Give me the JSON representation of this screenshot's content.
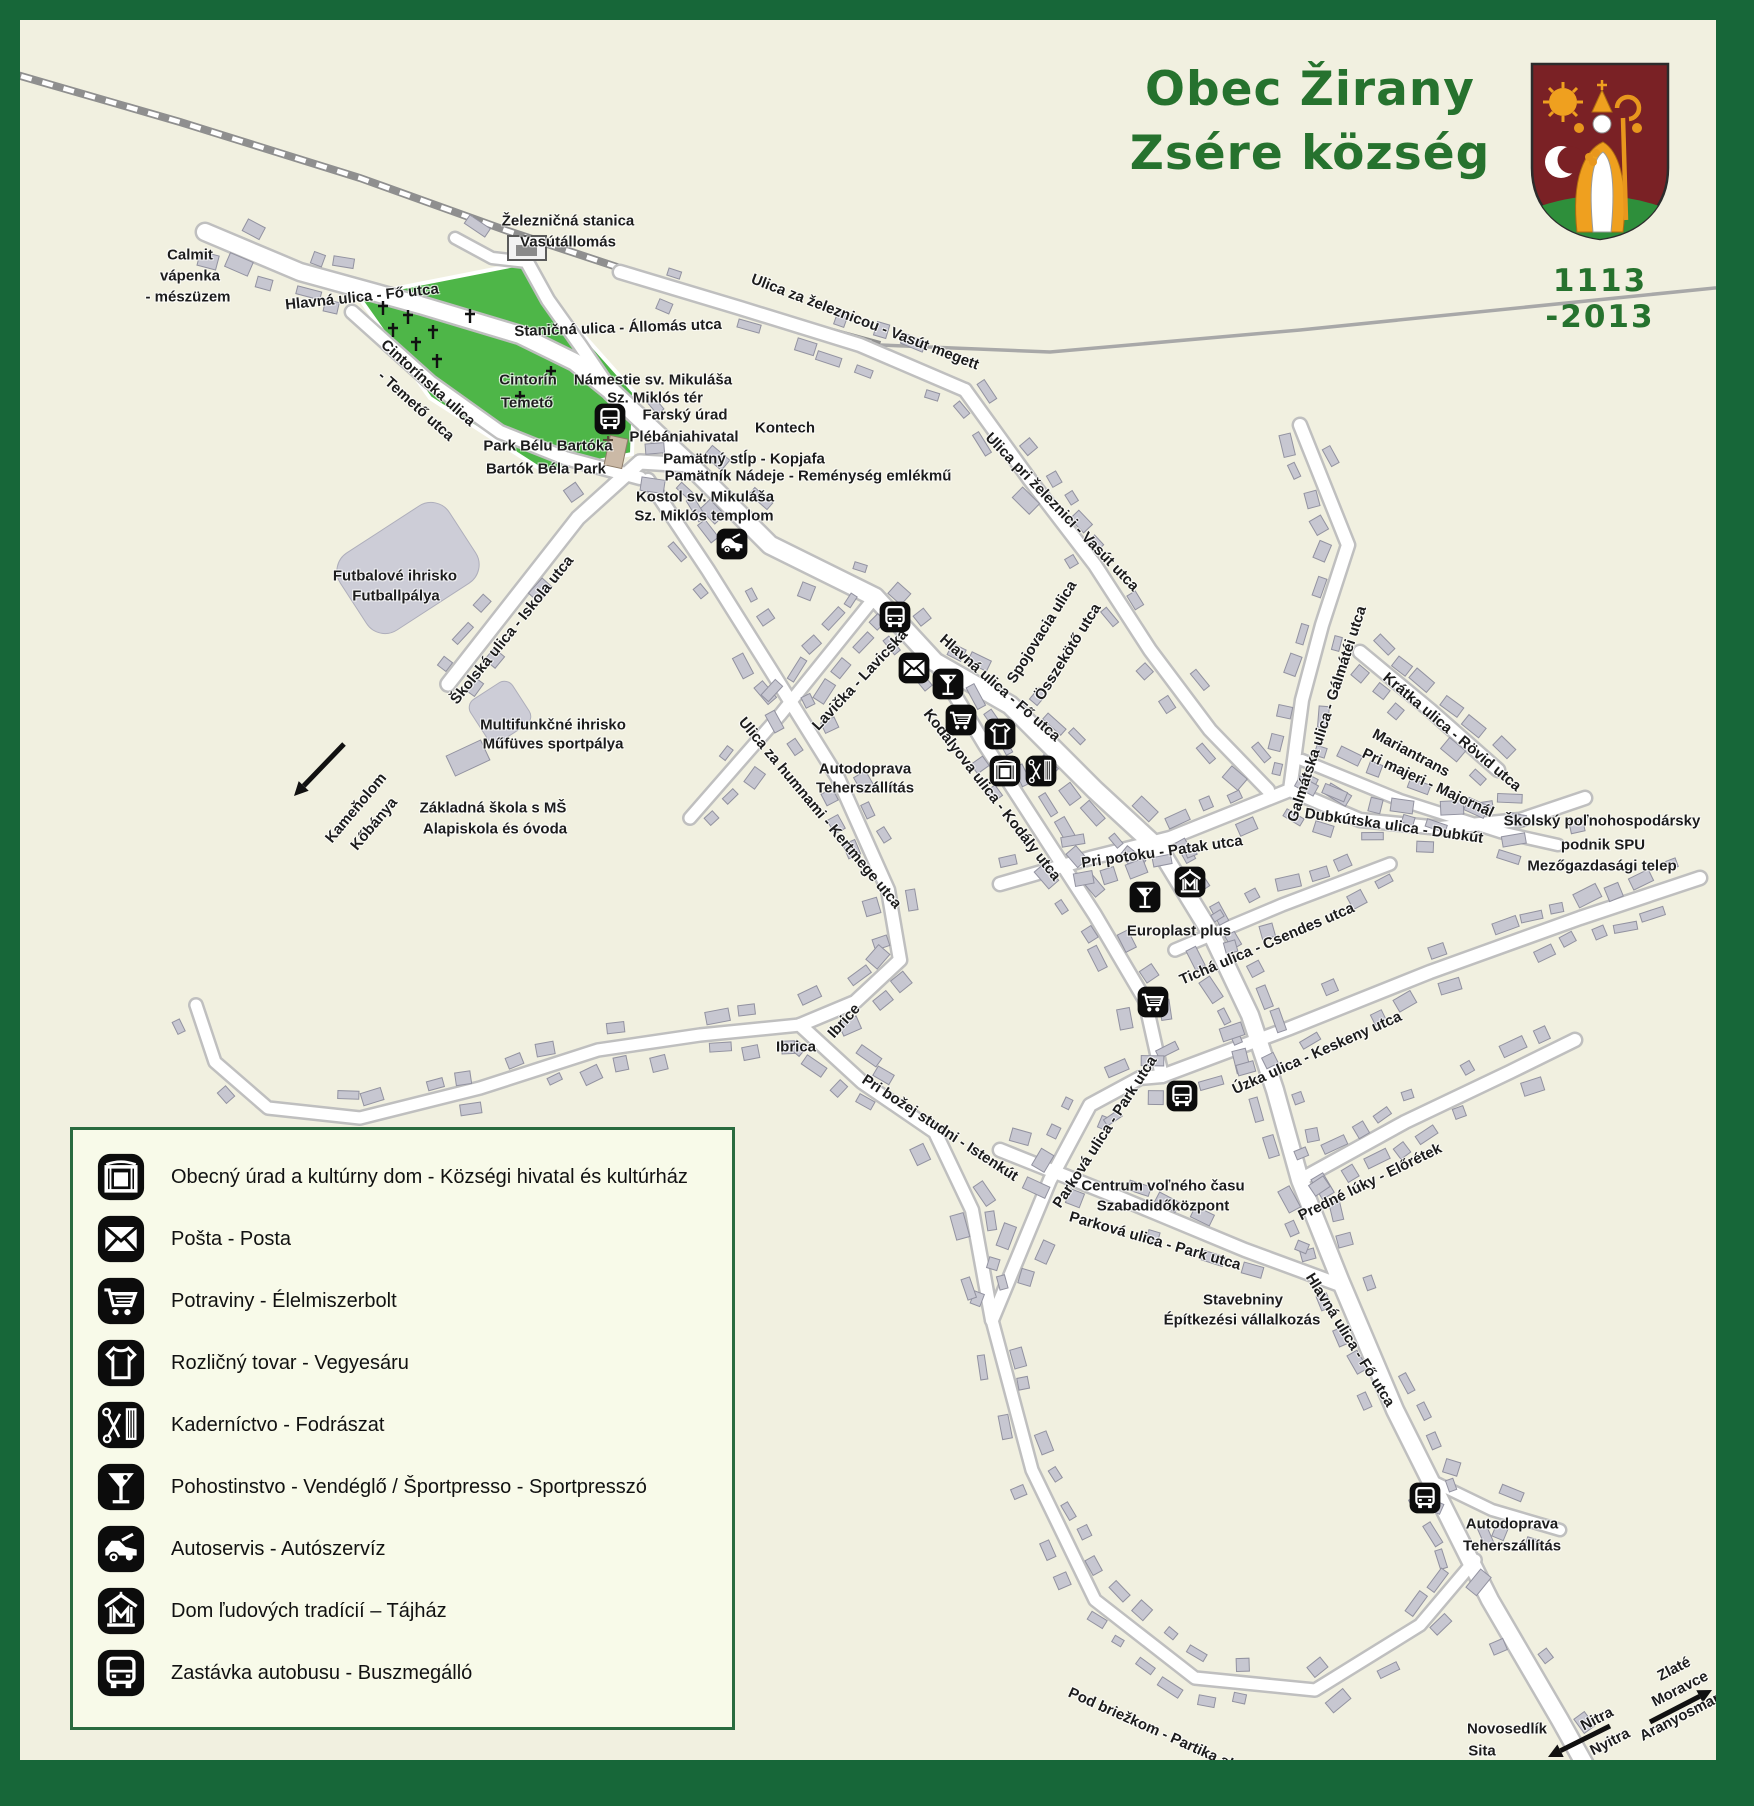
{
  "title": {
    "line1": "Obec Žirany",
    "line2": "Zsére község",
    "years": "1113 -2013"
  },
  "colors": {
    "frame": "#176739",
    "title_green": "#26722e",
    "map_bg": "#f1f0e0",
    "legend_bg": "#f8fae9",
    "green_area": "#4eb648",
    "road": "#ffffff",
    "road_casing": "#bfbfbf",
    "building": "#c7c7d1",
    "railway": "#8f8f8f",
    "icon_bg": "#0c0c0c",
    "shield_red": "#7a2125",
    "shield_green": "#2e8f3b",
    "shield_gold": "#efa01f"
  },
  "legend": {
    "items": [
      {
        "icon": "culture-house",
        "label": "Obecný úrad a kultúrny dom - Községi hivatal és kultúrház"
      },
      {
        "icon": "post",
        "label": "Pošta - Posta"
      },
      {
        "icon": "shop",
        "label": "Potraviny - Élelmiszerbolt"
      },
      {
        "icon": "clothes",
        "label": "Rozličný tovar - Vegyesáru"
      },
      {
        "icon": "hairdresser",
        "label": "Kaderníctvo - Fodrászat"
      },
      {
        "icon": "pub",
        "label": "Pohostinstvo - Vendéglő / Športpresso - Sportpresszó"
      },
      {
        "icon": "autoservice",
        "label": "Autoservis - Autószervíz"
      },
      {
        "icon": "heritage-house",
        "label": "Dom ľudových tradícií – Tájház"
      },
      {
        "icon": "bus",
        "label": "Zastávka autobusu - Buszmegálló"
      }
    ]
  },
  "map": {
    "labels": [
      {
        "text": "Calmit",
        "x": 170,
        "y": 235
      },
      {
        "text": "vápenka",
        "x": 170,
        "y": 256
      },
      {
        "text": "- mészüzem",
        "x": 168,
        "y": 277
      },
      {
        "text": "Hlavná ulica - Fő utca",
        "x": 342,
        "y": 277,
        "rot": -6
      },
      {
        "text": "Železničná stanica",
        "x": 548,
        "y": 201
      },
      {
        "text": "Vasútállomás",
        "x": 548,
        "y": 222
      },
      {
        "text": "Staničná ulica - Állomás utca",
        "x": 598,
        "y": 308,
        "rot": -2
      },
      {
        "text": "Ulica za železnicou - Vasút megett",
        "x": 845,
        "y": 302,
        "rot": 21
      },
      {
        "text": "Cintorínska ulica",
        "x": 408,
        "y": 363,
        "rot": 42
      },
      {
        "text": "- Temető utca",
        "x": 396,
        "y": 386,
        "rot": 42
      },
      {
        "text": "Cintorín",
        "x": 508,
        "y": 360
      },
      {
        "text": "Temető",
        "x": 507,
        "y": 383
      },
      {
        "text": "Námestie sv. Mikuláša",
        "x": 633,
        "y": 360
      },
      {
        "text": "Sz. Miklós tér",
        "x": 635,
        "y": 378
      },
      {
        "text": "Farský úrad",
        "x": 665,
        "y": 395
      },
      {
        "text": "Plébániahivatal",
        "x": 664,
        "y": 417
      },
      {
        "text": "Kontech",
        "x": 765,
        "y": 408
      },
      {
        "text": "Pamätný stĺp - Kopjafa",
        "x": 724,
        "y": 439
      },
      {
        "text": "Pamätník Nádeje - Reménység emlékmű",
        "x": 788,
        "y": 456
      },
      {
        "text": "Kostol sv. Mikuláša",
        "x": 685,
        "y": 477
      },
      {
        "text": "Sz. Miklós templom",
        "x": 684,
        "y": 496
      },
      {
        "text": "Park Bélu Bartóka",
        "x": 528,
        "y": 426
      },
      {
        "text": "Bartók Béla Park",
        "x": 526,
        "y": 449
      },
      {
        "text": "Futbalové ihrisko",
        "x": 375,
        "y": 556
      },
      {
        "text": "Futballpálya",
        "x": 376,
        "y": 576
      },
      {
        "text": "Školská ulica - Iskola utca",
        "x": 492,
        "y": 610,
        "rot": -51
      },
      {
        "text": "Multifunkčné ihrisko",
        "x": 533,
        "y": 705
      },
      {
        "text": "Műfüves sportpálya",
        "x": 533,
        "y": 724
      },
      {
        "text": "Kameňolom",
        "x": 336,
        "y": 788,
        "rot": -50
      },
      {
        "text": "Kőbánya",
        "x": 354,
        "y": 804,
        "rot": -50
      },
      {
        "text": "Základná škola s MŠ",
        "x": 473,
        "y": 788
      },
      {
        "text": "Alapiskola és óvoda",
        "x": 475,
        "y": 809
      },
      {
        "text": "Ulica pri železnici - Vasút utca",
        "x": 1042,
        "y": 492,
        "rot": 46
      },
      {
        "text": "Hlavná ulica - Fő utca",
        "x": 980,
        "y": 668,
        "rot": 41
      },
      {
        "text": "Spojovacia ulica",
        "x": 1022,
        "y": 612,
        "rot": -58
      },
      {
        "text": "Összekötő utca",
        "x": 1048,
        "y": 632,
        "rot": -58
      },
      {
        "text": "Lavička - Lavicska",
        "x": 840,
        "y": 660,
        "rot": -47
      },
      {
        "text": "Kodályova ulica - Kodály utca",
        "x": 972,
        "y": 775,
        "rot": 52
      },
      {
        "text": "Autodoprava",
        "x": 845,
        "y": 749
      },
      {
        "text": "Teherszállítás",
        "x": 845,
        "y": 768
      },
      {
        "text": "Ulica za humnami - Kertmege utca",
        "x": 800,
        "y": 793,
        "rot": 50
      },
      {
        "text": "Pri potoku - Patak utca",
        "x": 1142,
        "y": 832,
        "rot": -8
      },
      {
        "text": "Europlast plus",
        "x": 1159,
        "y": 911
      },
      {
        "text": "Tichá ulica - Csendes utca",
        "x": 1247,
        "y": 924,
        "rot": -23
      },
      {
        "text": "Úzka ulica - Keskeny utca",
        "x": 1297,
        "y": 1033,
        "rot": -24
      },
      {
        "text": "Ibrica",
        "x": 776,
        "y": 1027
      },
      {
        "text": "Ibrice",
        "x": 824,
        "y": 1001,
        "rot": -48
      },
      {
        "text": "Pri božej studni - Istenkút",
        "x": 920,
        "y": 1108,
        "rot": 33
      },
      {
        "text": "Galmátska ulica - Gálmátéi utca",
        "x": 1307,
        "y": 694,
        "rot": -72
      },
      {
        "text": "Krátka ulica - Rövid utca",
        "x": 1432,
        "y": 712,
        "rot": 40
      },
      {
        "text": "Mariantrans",
        "x": 1391,
        "y": 733,
        "rot": 28
      },
      {
        "text": "Pri majeri - Majornál",
        "x": 1408,
        "y": 763,
        "rot": 25
      },
      {
        "text": "Dubkútska ulica - Dubkút",
        "x": 1374,
        "y": 806,
        "rot": 8
      },
      {
        "text": "Školský poľnohospodársky",
        "x": 1582,
        "y": 801
      },
      {
        "text": "podnik SPU",
        "x": 1583,
        "y": 825
      },
      {
        "text": "Mezőgazdasági telep",
        "x": 1582,
        "y": 846
      },
      {
        "text": "Parková ulica - Park utca",
        "x": 1085,
        "y": 1112,
        "rot": -57
      },
      {
        "text": "Centrum voľného času",
        "x": 1143,
        "y": 1166
      },
      {
        "text": "Szabadidőközpont",
        "x": 1143,
        "y": 1186
      },
      {
        "text": "Parková ulica - Park utca",
        "x": 1135,
        "y": 1221,
        "rot": 16
      },
      {
        "text": "Predné lúky - Előrétek",
        "x": 1350,
        "y": 1162,
        "rot": -26
      },
      {
        "text": "Stavebniny",
        "x": 1223,
        "y": 1280
      },
      {
        "text": "Építkezési vállalkozás",
        "x": 1222,
        "y": 1300
      },
      {
        "text": "Hlavná ulica - Fő utca",
        "x": 1330,
        "y": 1320,
        "rot": 58
      },
      {
        "text": "Pod briežkom - Partika alatt",
        "x": 1139,
        "y": 1712,
        "rot": 24
      },
      {
        "text": "Autodoprava",
        "x": 1492,
        "y": 1504
      },
      {
        "text": "Teherszállítás",
        "x": 1492,
        "y": 1526
      },
      {
        "text": "Novosedlík",
        "x": 1487,
        "y": 1709
      },
      {
        "text": "Sita",
        "x": 1462,
        "y": 1731
      },
      {
        "text": "Nitra",
        "x": 1577,
        "y": 1699,
        "rot": -27
      },
      {
        "text": "Nyitra",
        "x": 1590,
        "y": 1722,
        "rot": -27
      },
      {
        "text": "Zlaté",
        "x": 1654,
        "y": 1649,
        "rot": -27
      },
      {
        "text": "Moravce",
        "x": 1660,
        "y": 1669,
        "rot": -27
      },
      {
        "text": "Aranyosmarót",
        "x": 1666,
        "y": 1694,
        "rot": -27
      }
    ],
    "icons": [
      {
        "type": "bus",
        "x": 590,
        "y": 399
      },
      {
        "type": "autoservice",
        "x": 712,
        "y": 524
      },
      {
        "type": "bus",
        "x": 875,
        "y": 597
      },
      {
        "type": "post",
        "x": 894,
        "y": 648
      },
      {
        "type": "pub",
        "x": 928,
        "y": 664
      },
      {
        "type": "shop",
        "x": 941,
        "y": 700
      },
      {
        "type": "clothes",
        "x": 980,
        "y": 714
      },
      {
        "type": "culture-house",
        "x": 985,
        "y": 751
      },
      {
        "type": "hairdresser",
        "x": 1021,
        "y": 751
      },
      {
        "type": "pub",
        "x": 1125,
        "y": 877
      },
      {
        "type": "heritage-house",
        "x": 1170,
        "y": 862
      },
      {
        "type": "shop",
        "x": 1133,
        "y": 982
      },
      {
        "type": "bus",
        "x": 1162,
        "y": 1076
      },
      {
        "type": "bus",
        "x": 1405,
        "y": 1478
      }
    ],
    "arrows": [
      {
        "x1": 344,
        "y1": 744,
        "x2": 294,
        "y2": 796
      },
      {
        "x1": 1610,
        "y1": 1726,
        "x2": 1548,
        "y2": 1757
      },
      {
        "x1": 1650,
        "y1": 1722,
        "x2": 1712,
        "y2": 1690
      }
    ]
  }
}
